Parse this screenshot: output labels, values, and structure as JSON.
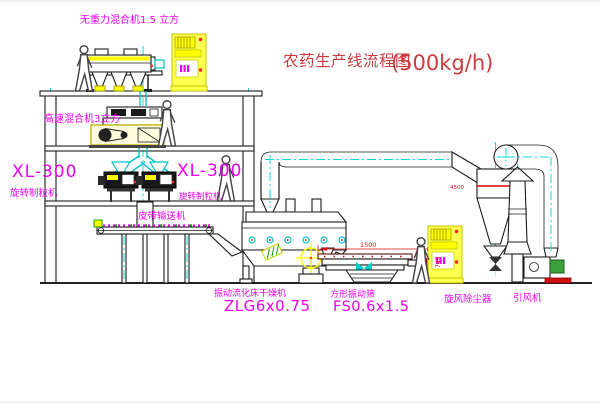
{
  "diagram": {
    "title": "农药生产线流程图",
    "capacity": "(500kg/h)"
  },
  "equipment_labels": {
    "gravity_mixer": "无重力混合机1.5 立方",
    "high_speed_mixer": "高速混合机3立方",
    "granulator_left_model": "XL-300",
    "granulator_left_name": "旋转制粒机",
    "granulator_mid_model": "XL-300",
    "granulator_mid_name": "旋转制粒机",
    "belt_conveyor": "皮带输送机",
    "dryer_name": "振动流化床干燥机",
    "dryer_model": "ZLG6x0.75",
    "sieve_name": "方形振动筛",
    "sieve_model": "FS0.6x1.5",
    "cyclone": "旋风除尘器",
    "fan": "引风机"
  },
  "dimensions": {
    "sieve_length": "1500",
    "sieve_height": "745",
    "cyclone_level": "4500"
  },
  "colors": {
    "label_magenta": "#ee00ee",
    "title_red": "#cd3b3f",
    "centerline_cyan": "#00d8d8",
    "cabinet_yellow": "#ffff00",
    "motor_green": "#3aa13a",
    "base_red": "#d01010"
  }
}
